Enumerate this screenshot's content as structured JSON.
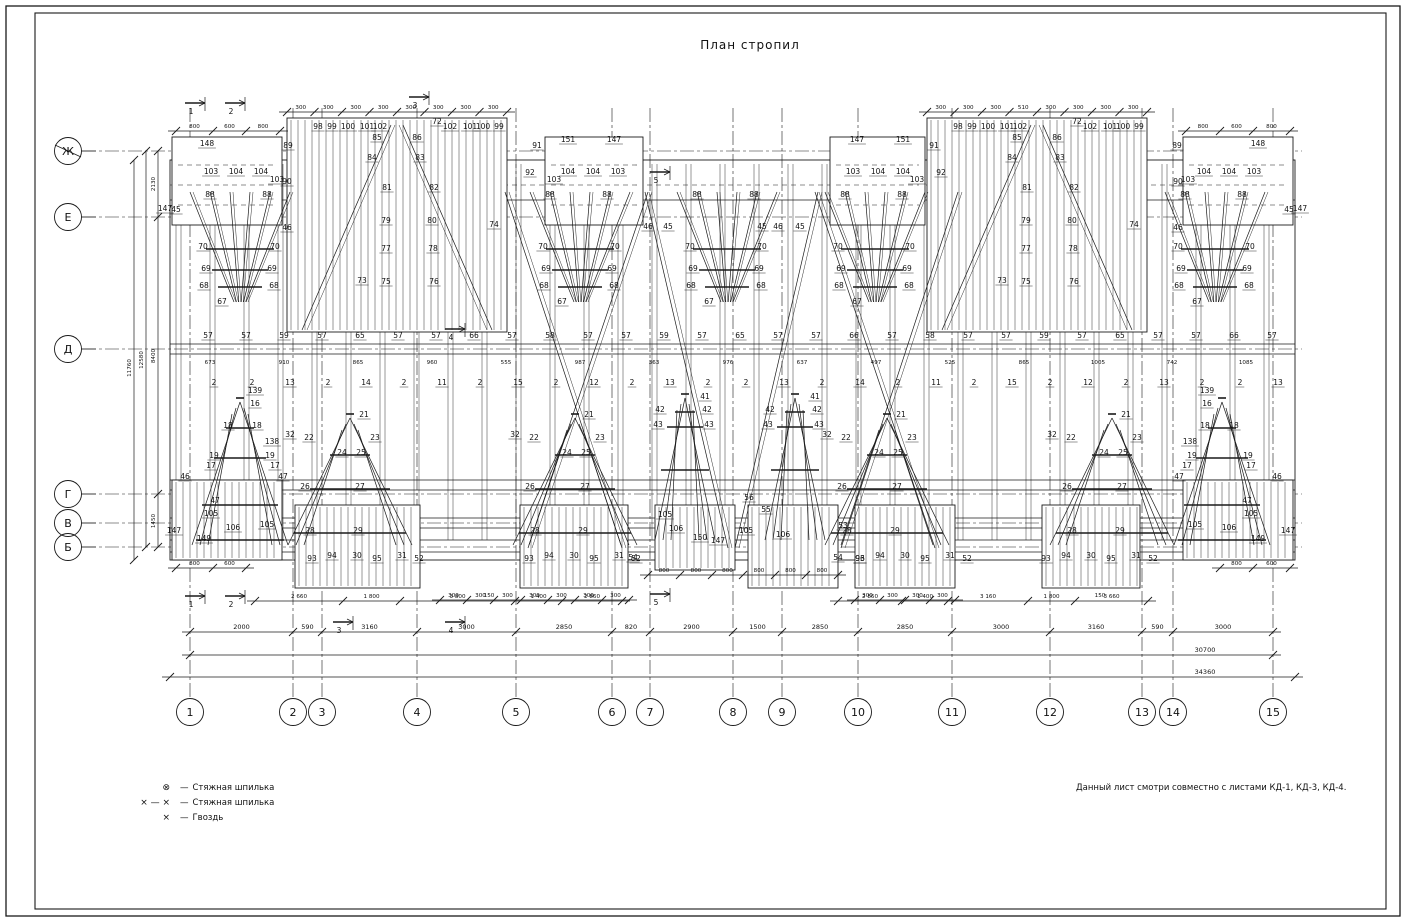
{
  "title": "План стропил",
  "note": "Данный лист смотри совместно с листами КД-1, КД-3, КД-4.",
  "legend": {
    "items": [
      {
        "symbol": "⊗",
        "separator": "—",
        "label": "Стяжная шпилька"
      },
      {
        "symbol": "× — ×",
        "separator": "—",
        "label": "Стяжная шпилька"
      },
      {
        "symbol": "×",
        "separator": "—",
        "label": "Гвоздь"
      }
    ]
  },
  "axes": {
    "rows": [
      {
        "label": "Ж",
        "y": 151
      },
      {
        "label": "Е",
        "y": 217
      },
      {
        "label": "Д",
        "y": 349
      },
      {
        "label": "Г",
        "y": 494
      },
      {
        "label": "В",
        "y": 523
      },
      {
        "label": "Б",
        "y": 547
      }
    ],
    "cols": [
      {
        "label": "1",
        "x": 190
      },
      {
        "label": "2",
        "x": 293
      },
      {
        "label": "3",
        "x": 322
      },
      {
        "label": "4",
        "x": 417
      },
      {
        "label": "5",
        "x": 516
      },
      {
        "label": "6",
        "x": 612
      },
      {
        "label": "7",
        "x": 650
      },
      {
        "label": "8",
        "x": 733
      },
      {
        "label": "9",
        "x": 782
      },
      {
        "label": "10",
        "x": 858
      },
      {
        "label": "11",
        "x": 952
      },
      {
        "label": "12",
        "x": 1050
      },
      {
        "label": "13",
        "x": 1142
      },
      {
        "label": "14",
        "x": 1173
      },
      {
        "label": "15",
        "x": 1273
      }
    ]
  },
  "dimensions": {
    "bottom_main": [
      "2000",
      "590",
      "3160",
      "3000",
      "2850",
      "820",
      "2900",
      "1500",
      "2850",
      "2850",
      "3000",
      "3160",
      "590",
      "3000"
    ],
    "total_inner": "30700",
    "total_outer": "34360",
    "secondary_left": [
      "2 660",
      "1 800",
      "3 800",
      "1 400",
      "2 860"
    ],
    "secondary_right": [
      "2 860",
      "1 400",
      "3 160",
      "1 800",
      "3 660"
    ],
    "center_eave": [
      "800",
      "800",
      "800",
      "800",
      "800",
      "800"
    ],
    "eave_top": [
      "800",
      "600",
      "800"
    ],
    "eave_bottom": [
      "800",
      "600"
    ],
    "left_chain": [
      "2130",
      "8400",
      "1450"
    ],
    "left_total_inner": "12580",
    "left_total_outer": "11760",
    "top_chain_left": [
      "300",
      "300",
      "300",
      "300",
      "300",
      "300",
      "300",
      "300"
    ],
    "top_chain_right": [
      "300",
      "300",
      "300",
      "510",
      "300",
      "300",
      "300",
      "300"
    ],
    "bottom_step": "300",
    "small_mark": "150",
    "band": [
      "673",
      "910",
      "865",
      "960",
      "555",
      "987",
      "363",
      "976",
      "637",
      "497",
      "525",
      "865",
      "1005",
      "742",
      "1085"
    ]
  },
  "rows": {
    "rafter_cycle": [
      "57",
      "57",
      "59",
      "57",
      "65",
      "57",
      "57",
      "66",
      "57",
      "58"
    ],
    "spacer_cycle": [
      "2",
      "2",
      "13",
      "2",
      "14",
      "2",
      "11",
      "2",
      "15",
      "2",
      "12",
      "2",
      "13"
    ]
  },
  "sections": [
    {
      "label": "1",
      "x": 197,
      "y": 103
    },
    {
      "label": "2",
      "x": 237,
      "y": 103
    },
    {
      "label": "3",
      "x": 421,
      "y": 97
    },
    {
      "label": "5",
      "x": 662,
      "y": 172
    },
    {
      "label": "4",
      "x": 457,
      "y": 329
    },
    {
      "label": "1",
      "x": 197,
      "y": 596
    },
    {
      "label": "2",
      "x": 237,
      "y": 596
    },
    {
      "label": "3",
      "x": 345,
      "y": 622
    },
    {
      "label": "4",
      "x": 457,
      "y": 622
    },
    {
      "label": "5",
      "x": 662,
      "y": 594
    }
  ],
  "labels": {
    "fan": [
      "88",
      "70",
      "69",
      "68",
      "67"
    ],
    "tri_end": [
      "139",
      "16",
      "18",
      "138",
      "19",
      "17",
      "47",
      "46",
      "105",
      "106",
      "147",
      "149"
    ],
    "tri_big": [
      "21",
      "22",
      "23",
      "24",
      "25",
      "26",
      "27",
      "28",
      "29",
      "32"
    ],
    "tri_small": [
      "41",
      "42",
      "43"
    ],
    "block_top": [
      "98",
      "99",
      "100",
      "101",
      "102",
      "72"
    ],
    "block_inner": [
      "85",
      "86",
      "84",
      "83",
      "81",
      "82",
      "79",
      "80",
      "77",
      "78",
      "75",
      "76",
      "73",
      "74"
    ],
    "end_top": [
      "148",
      "147",
      "103",
      "104",
      "89",
      "90",
      "45",
      "46"
    ],
    "mid_top": [
      "147",
      "151",
      "91",
      "92",
      "103",
      "104"
    ],
    "bottom_block": [
      "93",
      "94",
      "30",
      "95",
      "31",
      "52"
    ],
    "center_bottom": [
      "105",
      "106",
      "150",
      "147",
      "53",
      "54",
      "96",
      "55",
      "56"
    ],
    "eave_mid": [
      "45",
      "46"
    ]
  }
}
